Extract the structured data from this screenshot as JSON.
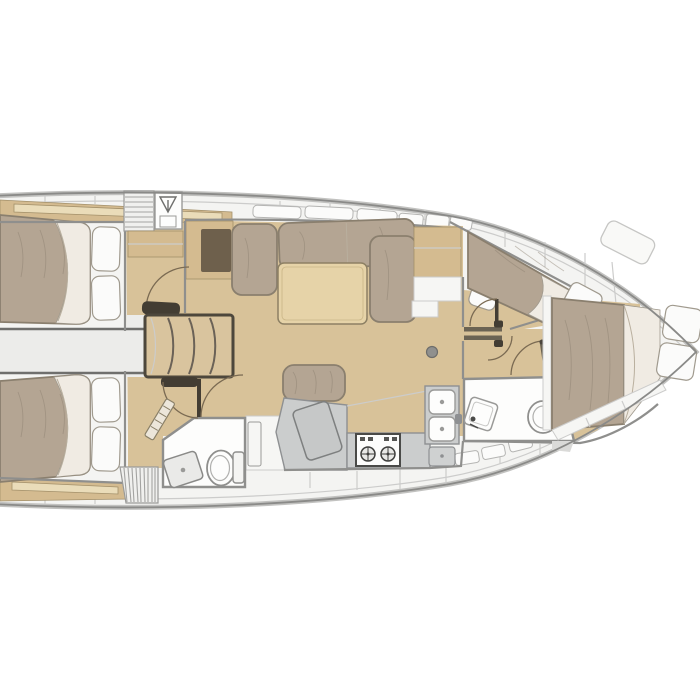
{
  "meta": {
    "description": "Top-down sailboat interior floor plan (no visible text labels in image)"
  },
  "colors": {
    "bg": "#ffffff",
    "deck": "#f4f4f2",
    "deck_line": "#cccccb",
    "hull_band": "#c2c2c0",
    "hull_line": "#8a8a88",
    "window": "#fbfbfa",
    "window_edge": "#b5b5b3",
    "wall": "#8f8f8d",
    "wall_dark": "#6f6f6d",
    "floor": "#d8c299",
    "wood": "#d4bb90",
    "wood_light": "#eadcb9",
    "wood_edge": "#a3906a",
    "mattress": "#b4a593",
    "mattress_edge": "#8a7f6e",
    "sheet": "#f0ebe3",
    "pillow": "#fbfbfa",
    "pillow_edge": "#a09a8e",
    "gap": "#ececea",
    "hatch_bg": "#f0f0ee",
    "hatch_line": "#a3a3a1",
    "counter": "#cbcdcd",
    "counter_edge": "#8e9092",
    "fixture": "#fdfdfc",
    "fixture_edge": "#9a9a98",
    "dark_leaf": "#433d33",
    "door_arc": "#7a6a52",
    "steps_frame": "#4d473c",
    "steps_wood": "#d9c49e",
    "steps_line": "#6b6257",
    "table": "#e6d3a8",
    "table_edge": "#8d8064",
    "desk_inset": "#6e604c"
  },
  "inventory": {
    "areas": [
      {
        "name": "aft-cabin-port",
        "items": [
          "double-berth",
          "pillows",
          "shelf"
        ]
      },
      {
        "name": "aft-cabin-starboard",
        "items": [
          "double-berth",
          "pillows",
          "shelf"
        ]
      },
      {
        "name": "companionway",
        "items": [
          "steps",
          "hatch-grate",
          "hanging-locker"
        ]
      },
      {
        "name": "nav-station",
        "items": [
          "chart-table",
          "seat-inset"
        ]
      },
      {
        "name": "salon",
        "items": [
          "u-settee",
          "table",
          "bench",
          "sideboard",
          "mast-post"
        ]
      },
      {
        "name": "galley",
        "items": [
          "fridge-lid",
          "stove-2-burner",
          "double-sink",
          "locker"
        ]
      },
      {
        "name": "aft-head",
        "items": [
          "shower-tray",
          "toilet",
          "doors"
        ]
      },
      {
        "name": "forward-head",
        "items": [
          "sink",
          "toilet",
          "door"
        ]
      },
      {
        "name": "forward-cabin",
        "items": [
          "island-berth",
          "pillows",
          "side-berth",
          "sliding-door"
        ]
      }
    ]
  }
}
